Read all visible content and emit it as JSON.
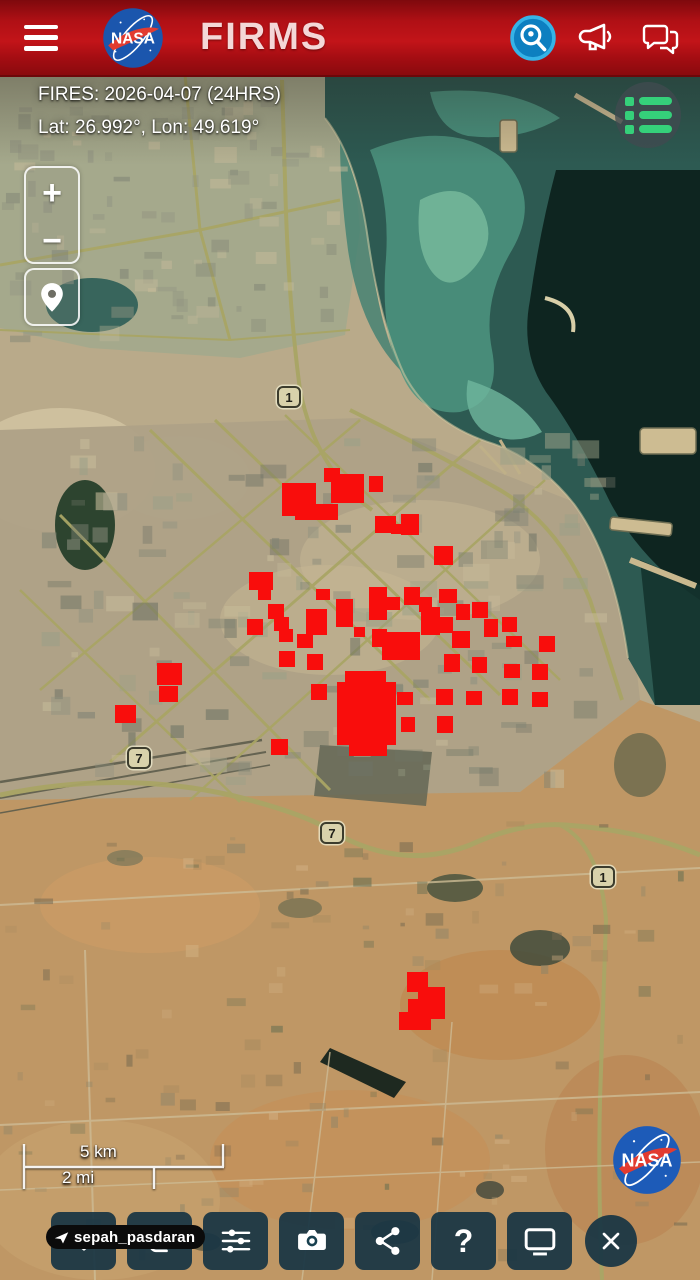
{
  "header": {
    "brand": "NASA",
    "title": "FIRMS",
    "menu_icon": "hamburger-icon",
    "actions": [
      {
        "name": "search",
        "icon": "search-location-icon"
      },
      {
        "name": "announcements",
        "icon": "megaphone-icon"
      },
      {
        "name": "feedback",
        "icon": "chat-bubbles-icon"
      }
    ]
  },
  "status": {
    "fires_line": "FIRES: 2026-04-07 (24HRS)",
    "coords_line": "Lat: 26.992°, Lon: 49.619°"
  },
  "map_controls": {
    "zoom_in": "+",
    "zoom_out": "−",
    "locate_icon": "map-pin-icon",
    "layers_icon": "green-list-icon"
  },
  "map": {
    "fire_color": "#f90d0c",
    "route_shields": [
      {
        "label": "1",
        "x": 277,
        "y": 386
      },
      {
        "label": "7",
        "x": 127,
        "y": 747
      },
      {
        "label": "7",
        "x": 320,
        "y": 822
      },
      {
        "label": "1",
        "x": 591,
        "y": 866
      }
    ],
    "fires": [
      [
        282,
        483,
        34,
        33
      ],
      [
        295,
        504,
        43,
        16
      ],
      [
        331,
        474,
        33,
        29
      ],
      [
        324,
        468,
        16,
        14
      ],
      [
        369,
        476,
        14,
        16
      ],
      [
        375,
        516,
        21,
        17
      ],
      [
        391,
        524,
        15,
        10
      ],
      [
        401,
        514,
        18,
        21
      ],
      [
        434,
        546,
        19,
        19
      ],
      [
        249,
        572,
        24,
        18
      ],
      [
        258,
        589,
        13,
        11
      ],
      [
        247,
        619,
        16,
        16
      ],
      [
        268,
        604,
        16,
        15
      ],
      [
        274,
        617,
        15,
        14
      ],
      [
        279,
        629,
        14,
        13
      ],
      [
        297,
        634,
        16,
        14
      ],
      [
        306,
        609,
        21,
        26
      ],
      [
        316,
        589,
        14,
        11
      ],
      [
        336,
        599,
        17,
        28
      ],
      [
        354,
        627,
        11,
        10
      ],
      [
        369,
        587,
        18,
        33
      ],
      [
        372,
        629,
        15,
        18
      ],
      [
        387,
        597,
        13,
        13
      ],
      [
        404,
        587,
        16,
        18
      ],
      [
        419,
        597,
        13,
        15
      ],
      [
        382,
        632,
        38,
        28
      ],
      [
        421,
        607,
        19,
        28
      ],
      [
        437,
        617,
        16,
        16
      ],
      [
        439,
        589,
        18,
        14
      ],
      [
        456,
        604,
        14,
        16
      ],
      [
        472,
        602,
        16,
        16
      ],
      [
        452,
        631,
        18,
        17
      ],
      [
        484,
        619,
        14,
        18
      ],
      [
        502,
        617,
        15,
        15
      ],
      [
        506,
        636,
        16,
        11
      ],
      [
        539,
        636,
        16,
        16
      ],
      [
        279,
        651,
        16,
        16
      ],
      [
        307,
        654,
        16,
        16
      ],
      [
        444,
        654,
        16,
        18
      ],
      [
        472,
        657,
        15,
        16
      ],
      [
        504,
        664,
        16,
        14
      ],
      [
        532,
        664,
        16,
        16
      ],
      [
        311,
        684,
        16,
        16
      ],
      [
        397,
        692,
        16,
        13
      ],
      [
        436,
        689,
        17,
        16
      ],
      [
        466,
        691,
        16,
        14
      ],
      [
        502,
        689,
        16,
        16
      ],
      [
        532,
        692,
        16,
        15
      ],
      [
        401,
        717,
        14,
        15
      ],
      [
        437,
        716,
        16,
        17
      ],
      [
        271,
        739,
        17,
        16
      ],
      [
        115,
        705,
        21,
        18
      ],
      [
        157,
        663,
        25,
        22
      ],
      [
        159,
        686,
        19,
        16
      ],
      [
        345,
        671,
        41,
        17
      ],
      [
        337,
        682,
        59,
        63
      ],
      [
        349,
        739,
        38,
        17
      ],
      [
        407,
        972,
        21,
        20
      ],
      [
        418,
        987,
        27,
        32
      ],
      [
        399,
        1012,
        32,
        18
      ],
      [
        408,
        999,
        15,
        15
      ]
    ]
  },
  "scale_bar": {
    "km_label": "5 km",
    "mi_label": "2 mi"
  },
  "watermark": {
    "text": "sepah_pasdaran",
    "icon": "paper-plane-icon"
  },
  "attribution": {
    "logo_text": "NASA"
  },
  "toolbar": {
    "help_glyph": "?",
    "buttons": [
      {
        "name": "favorite",
        "icon": "heart-icon"
      },
      {
        "name": "basemap-switch",
        "icon": "copy-squares-icon"
      },
      {
        "name": "adjustments",
        "icon": "sliders-icon"
      },
      {
        "name": "screenshot",
        "icon": "camera-icon"
      },
      {
        "name": "share",
        "icon": "share-nodes-icon"
      },
      {
        "name": "help",
        "icon": "question-mark-icon"
      },
      {
        "name": "desktop-view",
        "icon": "monitor-icon"
      },
      {
        "name": "close",
        "icon": "close-x-icon"
      }
    ]
  }
}
